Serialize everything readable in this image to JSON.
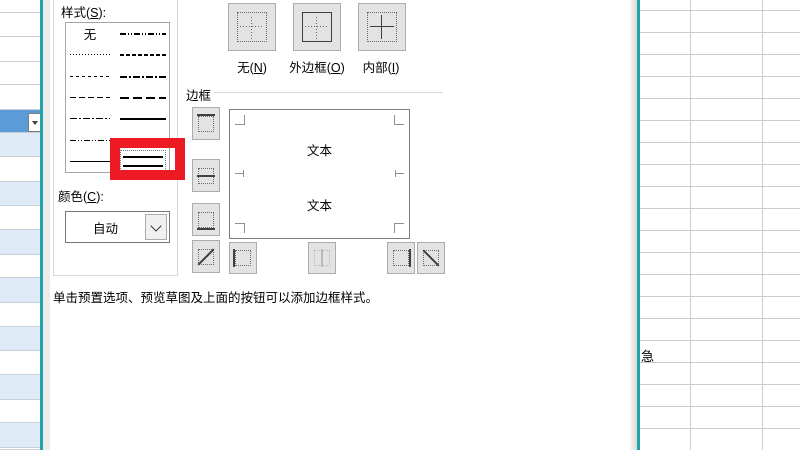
{
  "colors": {
    "accent_teal": "#25A2A8",
    "annotation_red": "#EC1A23",
    "selected_row_blue": "#5B9CD8",
    "banded_row_blue": "#DEEAF6",
    "gridline_gray": "#C9CDD1"
  },
  "left_sheet": {
    "row_boundaries": [
      0,
      13,
      37,
      62,
      85,
      110,
      133,
      157,
      182,
      206,
      230,
      255,
      278,
      303,
      327,
      351,
      375,
      400,
      423,
      448,
      450
    ],
    "selected_segment": 5,
    "banding_start": 6,
    "dropdown_icon": "dropdown-arrow-icon"
  },
  "right_sheet": {
    "cell_text": "急",
    "h_line_start": 10,
    "h_line_step": 22,
    "v_lines": [
      50,
      122
    ]
  },
  "dialog": {
    "line_group": {
      "style_label": "样式(S):",
      "color_label": "颜色(C):",
      "color_value": "自动",
      "styles_left": [
        {
          "name": "none",
          "label": "无"
        },
        {
          "name": "hair"
        },
        {
          "name": "dotted"
        },
        {
          "name": "dashed"
        },
        {
          "name": "dash-dot"
        },
        {
          "name": "dash-dot-dot"
        },
        {
          "name": "thin"
        }
      ],
      "styles_right": [
        {
          "name": "medium-dash-dot-dot"
        },
        {
          "name": "slant-dash-dot"
        },
        {
          "name": "medium-dash-dot"
        },
        {
          "name": "medium-dashed"
        },
        {
          "name": "medium"
        },
        {
          "name": "thick"
        },
        {
          "name": "double",
          "selected": true
        }
      ]
    },
    "presets": {
      "buttons": [
        {
          "label": "无(N)",
          "icon": "preset-none-icon"
        },
        {
          "label": "外边框(O)",
          "icon": "preset-outline-icon"
        },
        {
          "label": "内部(I)",
          "icon": "preset-inside-icon"
        }
      ]
    },
    "border_group": {
      "label": "边框",
      "preview_texts": [
        "文本",
        "文本"
      ],
      "side_buttons": [
        {
          "icon": "border-top-icon"
        },
        {
          "icon": "border-inner-horizontal-icon"
        },
        {
          "icon": "border-bottom-icon"
        },
        {
          "icon": "border-diagonal-up-icon"
        }
      ],
      "bottom_buttons": [
        {
          "icon": "border-left-icon"
        },
        {
          "icon": "border-inner-vertical-icon",
          "disabled": true
        },
        {
          "icon": "border-right-icon"
        },
        {
          "icon": "border-diagonal-down-icon"
        }
      ]
    },
    "hint": "单击预置选项、预览草图及上面的按钮可以添加边框样式。"
  }
}
